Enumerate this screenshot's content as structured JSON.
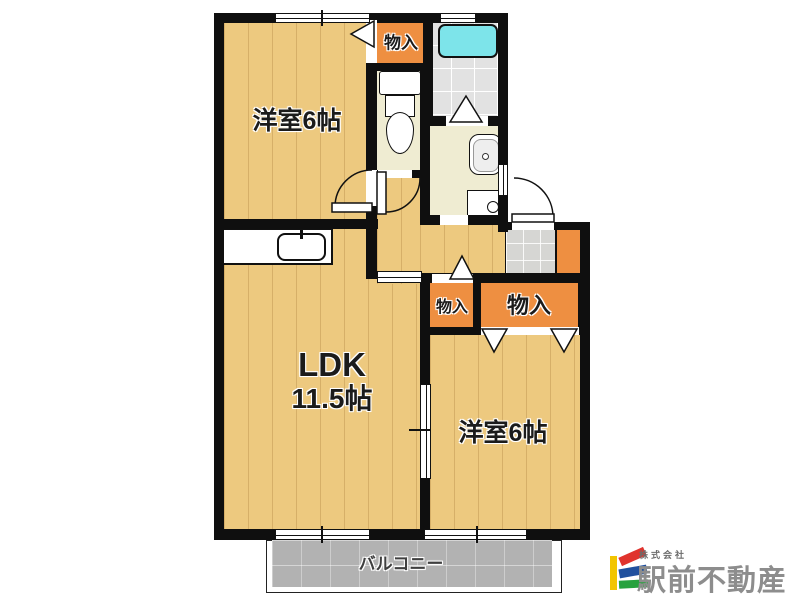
{
  "floor_plan": {
    "rooms": {
      "bedroom_top": {
        "label": "洋室6帖"
      },
      "bedroom_bottom": {
        "label": "洋室6帖"
      },
      "ldk": {
        "label_line1": "LDK",
        "label_line2": "11.5帖"
      },
      "closet_top": {
        "label": "物入"
      },
      "closet_small": {
        "label": "物入"
      },
      "closet_large": {
        "label": "物入"
      },
      "balcony": {
        "label": "バルコニー"
      }
    },
    "fixtures": {
      "bathtub": "bathtub",
      "toilet": "toilet",
      "washbasin": "washbasin",
      "washing_machine_pan": "washing-machine-pan",
      "kitchen_sink": "kitchen-sink",
      "shoe_cabinet": "shoe-cabinet"
    },
    "colors": {
      "wall": "#0f0f0f",
      "wood_floor": "#edc97f",
      "closet_orange": "#ee8f41",
      "bathtub_cyan": "#7de4ea",
      "cream_floor": "#efecd2",
      "bath_tile": "#e2e2e2",
      "entrance_tile": "#d6d6d3",
      "balcony_gray": "#b2b2b2"
    }
  },
  "logo": {
    "company_prefix": "株式会社",
    "company_name": "駅前不動産",
    "mark_colors": {
      "yellow": "#f2c500",
      "red": "#e0332d",
      "blue": "#20509e",
      "green": "#27a23e"
    },
    "text_color": "#8d8d8d"
  }
}
